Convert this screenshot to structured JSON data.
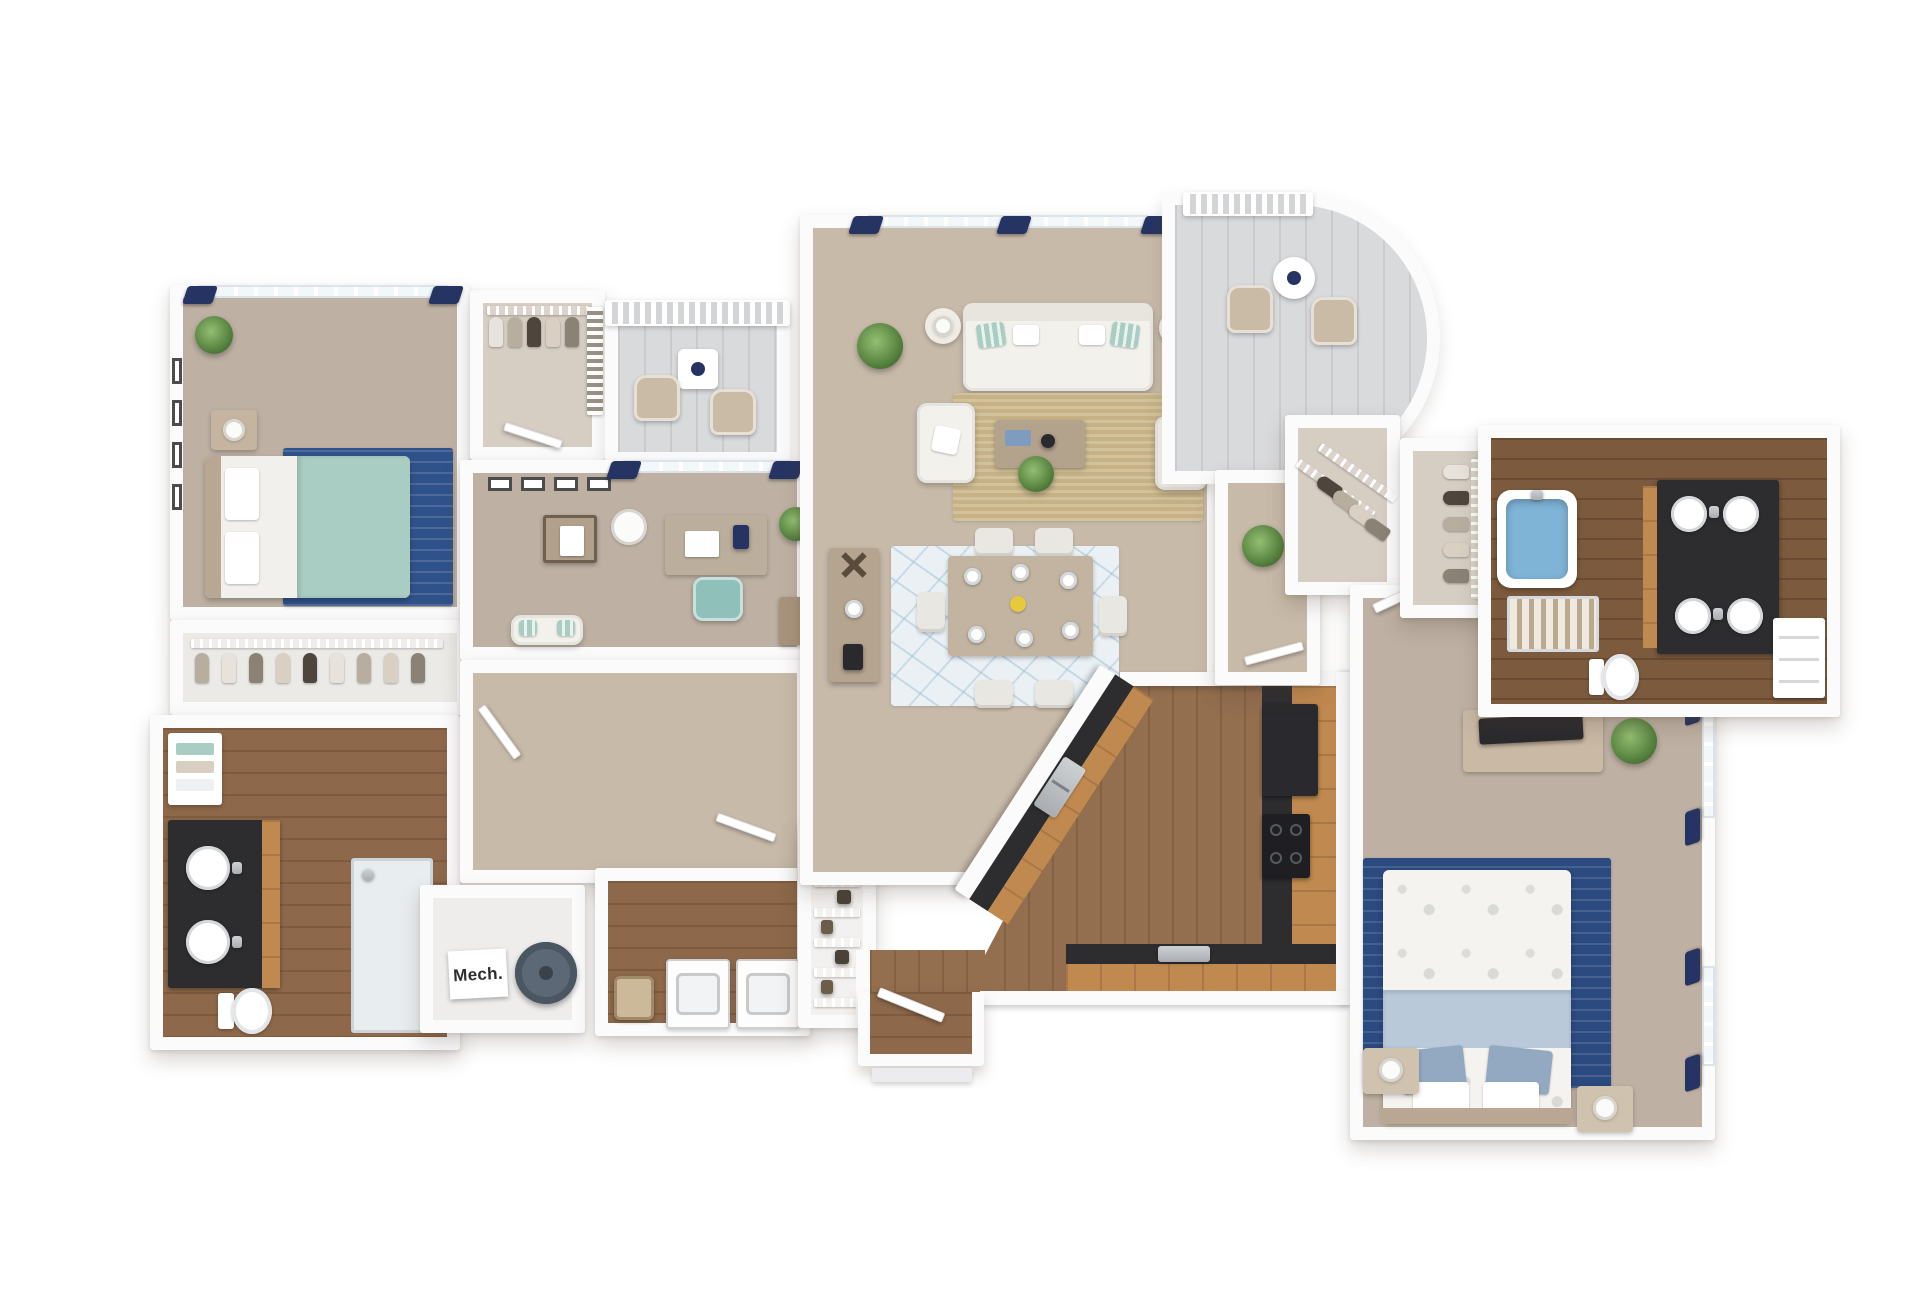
{
  "labels": {
    "mech": "Mech."
  },
  "palette": {
    "wall": "#fbfbfc",
    "carpet": "#c8baa9",
    "carpet2": "#beb1a3",
    "wood": "#8d684a",
    "wood2": "#7c5a3d",
    "kwood": "#936e4f",
    "cabinet": "#c0894f",
    "counter": "#2d2d30",
    "steelc": "#b8bcc0",
    "navy": "#263463",
    "teal": "#a9cdc2",
    "jute": "#c6b285",
    "rugblue": "#30528b",
    "rugblue2": "#2a4a80",
    "dinrug": "#eaf0f4",
    "tub": "#7fb4d7",
    "plant": "#55813f",
    "tile": "#d9dadc"
  },
  "scene": {
    "type": "3d-floor-plan-render",
    "view": "top-down dollhouse",
    "rooms": [
      {
        "name": "bedroom-2",
        "floor": "carpet",
        "furniture": [
          "queen-bed-teal-duvet",
          "blue-area-rug",
          "nightstand-lamp",
          "potted-plant",
          "four-wall-frames",
          "window-navy-curtains"
        ]
      },
      {
        "name": "bedroom-2-closet",
        "floor": "carpet",
        "furniture": [
          "wire-shelf",
          "hanging-clothes"
        ]
      },
      {
        "name": "hall-bathroom",
        "floor": "hardwood",
        "furniture": [
          "double-sink-dark-vanity",
          "toilet",
          "walk-in-shower",
          "linen-shelf-towels"
        ]
      },
      {
        "name": "walk-in-closet-1",
        "floor": "carpet",
        "furniture": [
          "wire-shelf",
          "hanging-clothes",
          "storage-rack"
        ]
      },
      {
        "name": "balcony-1",
        "floor": "tile",
        "furniture": [
          "two-patio-chairs",
          "side-table",
          "railing"
        ]
      },
      {
        "name": "den-office",
        "floor": "carpet",
        "furniture": [
          "desk",
          "teal-office-chair",
          "floor-lamp",
          "side-table",
          "loveseat",
          "bookcase",
          "potted-plant",
          "window-navy-curtains",
          "wall-frames"
        ]
      },
      {
        "name": "hallway",
        "floor": "carpet",
        "furniture": [
          "doors"
        ]
      },
      {
        "name": "mech-room",
        "floor": "vinyl",
        "furniture": [
          "water-heater"
        ],
        "label": "Mech."
      },
      {
        "name": "laundry-room",
        "floor": "hardwood",
        "furniture": [
          "washer",
          "dryer",
          "laundry-basket"
        ]
      },
      {
        "name": "pantry",
        "floor": "vinyl",
        "furniture": [
          "wire-shelving",
          "stored-goods"
        ]
      },
      {
        "name": "living-room",
        "floor": "carpet",
        "furniture": [
          "sofa",
          "two-armchairs",
          "coffee-table",
          "jute-rug",
          "two-lamp-side-tables",
          "palm-plant",
          "potted-plant",
          "windows-navy-curtains",
          "balcony-door"
        ]
      },
      {
        "name": "dining-area",
        "floor": "carpet",
        "furniture": [
          "dining-table-for-six",
          "patterned-blue-rug",
          "bar-console"
        ]
      },
      {
        "name": "kitchen",
        "floor": "hardwood",
        "furniture": [
          "angled-peninsula-double-sink",
          "refrigerator",
          "range-cooktop",
          "toaster",
          "wood-cabinets-dark-counters"
        ]
      },
      {
        "name": "entry",
        "floor": "hardwood",
        "furniture": [
          "front-door"
        ]
      },
      {
        "name": "master-hall",
        "floor": "carpet",
        "furniture": [
          "potted-plant",
          "door"
        ]
      },
      {
        "name": "walk-in-closet-2",
        "floor": "carpet",
        "furniture": [
          "angled-wire-shelves",
          "hanging-clothes"
        ]
      },
      {
        "name": "walk-in-closet-3",
        "floor": "carpet",
        "furniture": [
          "wire-shelf",
          "hanging-clothes"
        ]
      },
      {
        "name": "master-bathroom",
        "floor": "hardwood",
        "furniture": [
          "blue-soaking-tub",
          "walk-in-shower",
          "dark-double-vanity-four-basins",
          "toilet",
          "linen-closet"
        ]
      },
      {
        "name": "master-bedroom",
        "floor": "carpet",
        "furniture": [
          "king-bed-leaf-duvet",
          "blue-area-rug",
          "two-nightstand-lamps",
          "dresser-with-tv",
          "potted-plant",
          "two-windows-navy-curtains"
        ]
      },
      {
        "name": "balcony-2-curved",
        "floor": "tile",
        "furniture": [
          "curved-railing",
          "two-patio-chairs",
          "round-table"
        ]
      }
    ]
  }
}
